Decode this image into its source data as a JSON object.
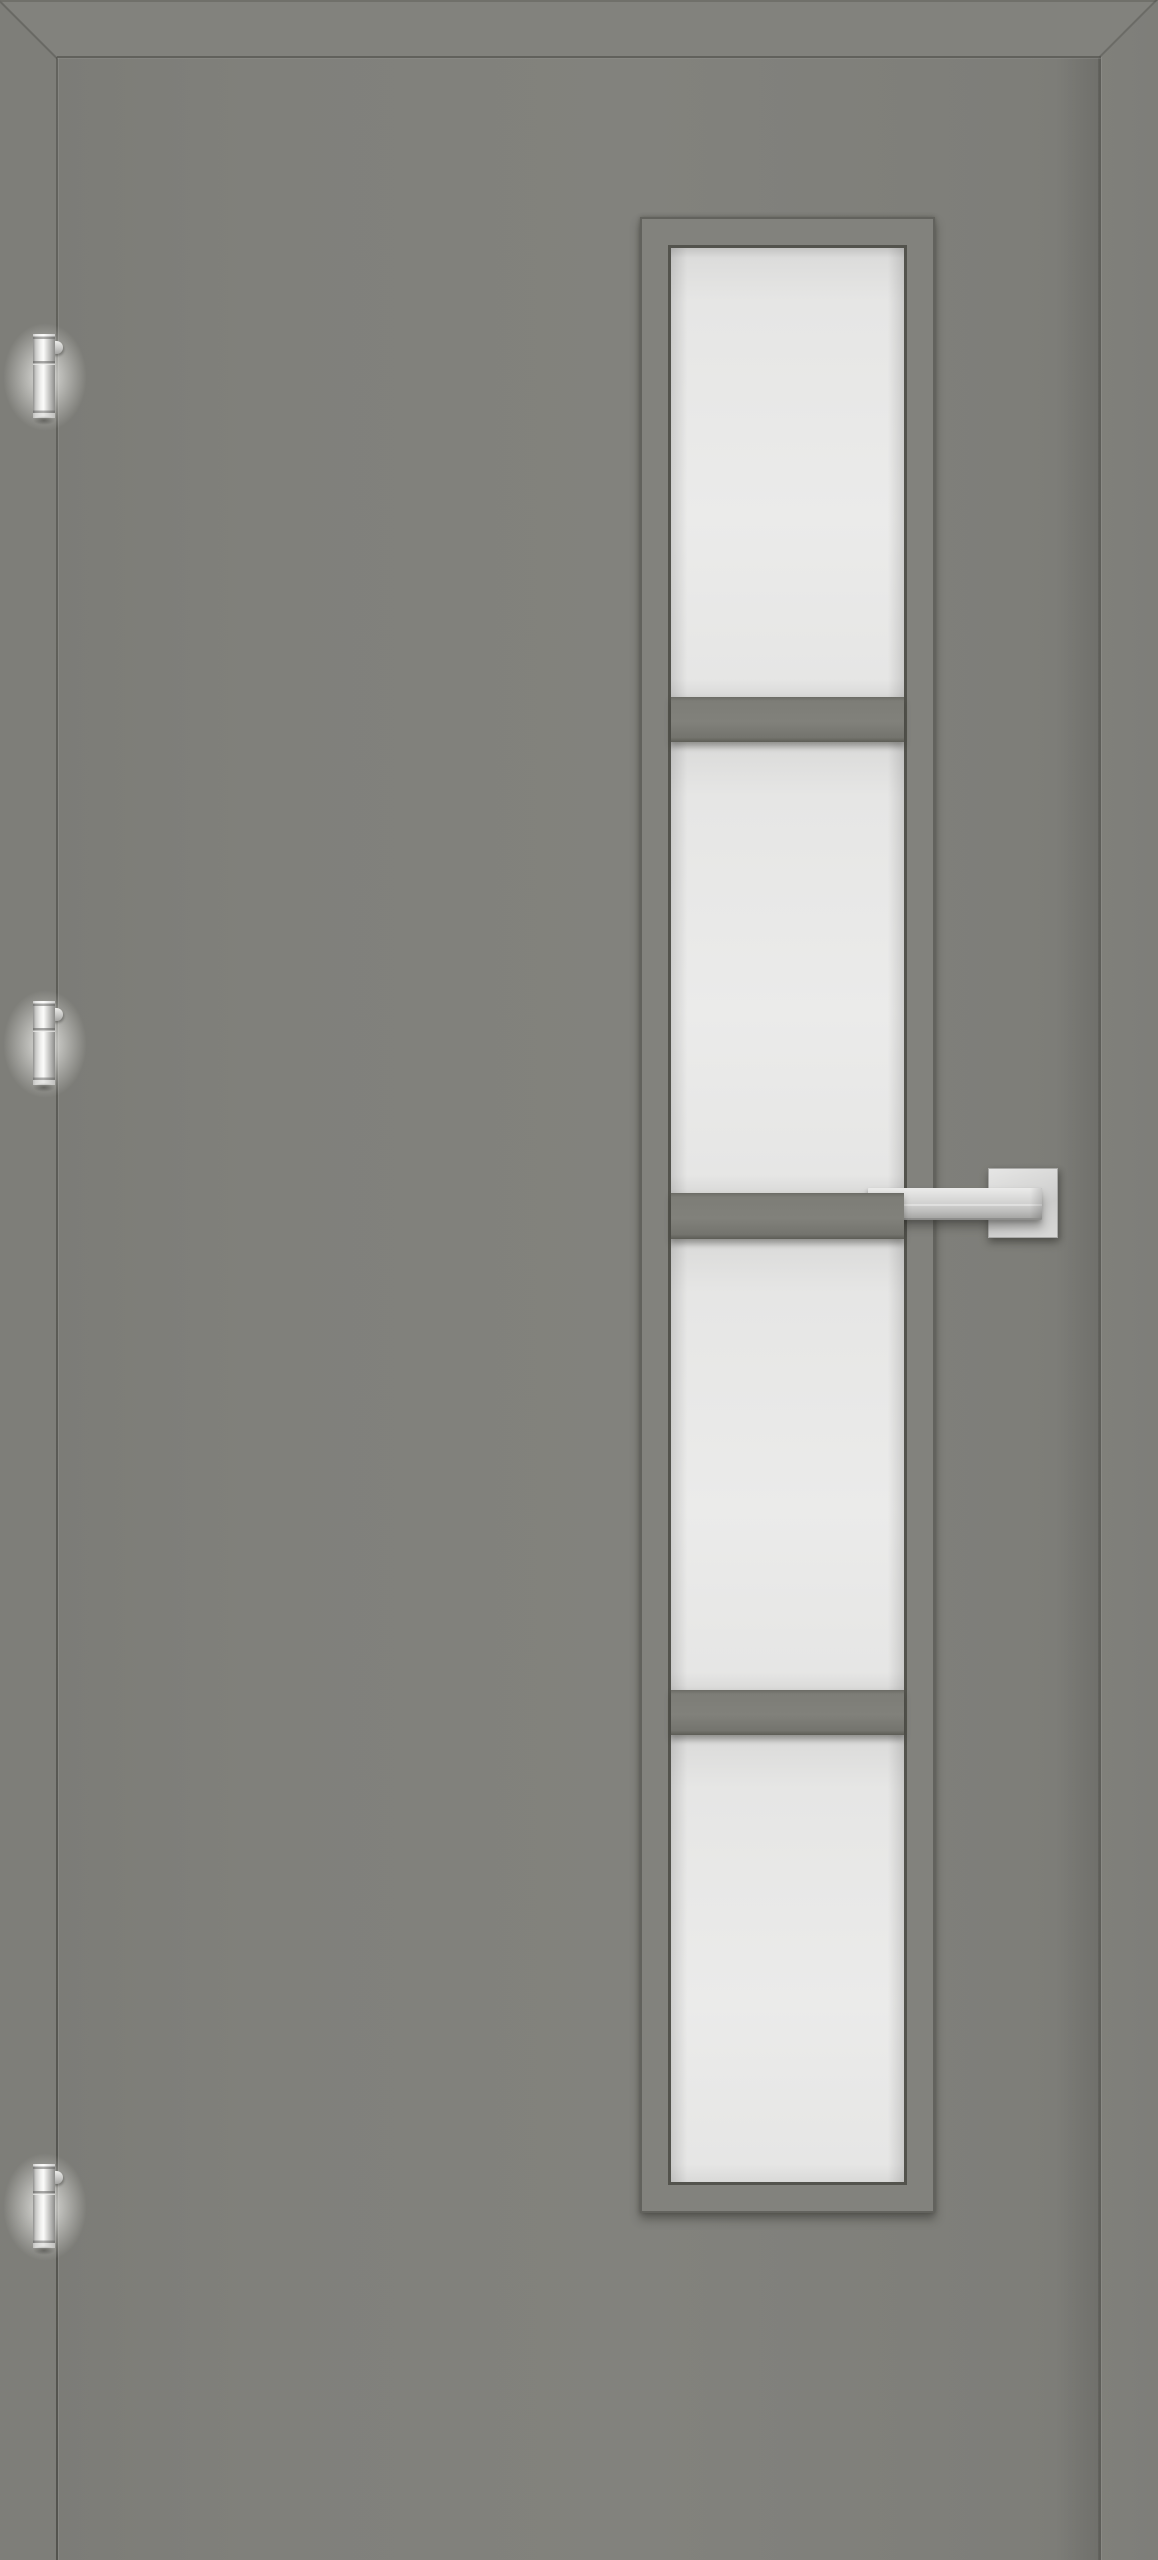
{
  "scene": {
    "type": "product-image",
    "subject": "Grey interior door with vertical 4-pane frosted glazing strip, stainless lever handle, three barrel hinges",
    "door": {
      "edge_width_px": 57,
      "face_color": "#7d7d78",
      "seam_color": "#5a5a55"
    },
    "glazing": {
      "frame": {
        "x": 640,
        "y": 217,
        "width": 295,
        "height": 1996,
        "band_px": 28
      },
      "pane_count": 4,
      "pane_heights_px": [
        450,
        452,
        452,
        448
      ],
      "muntin_height_px": 46,
      "glass_color": "#e8e8e8",
      "frame_color": "#82827d",
      "bead_color": "#53534d"
    },
    "handle": {
      "style": "square-rosette-lever",
      "finish": "brushed-stainless",
      "rosette": {
        "x": 988,
        "y": 1168,
        "size": 70
      },
      "lever": {
        "x": 868,
        "y": 1188,
        "width": 174,
        "height": 30
      }
    },
    "hinges": {
      "count": 3,
      "finish": "silver-barrel",
      "x": 33,
      "width": 22,
      "height": 84,
      "tops_y": [
        334,
        1001,
        2164
      ]
    },
    "colors": {
      "face": "#7d7d78",
      "face_light": "#83837e",
      "band_dark": "#6b6b66",
      "seam": "#5a5a55",
      "frame_outline": "#62625d",
      "bead": "#53534d",
      "glass": "#e8e8e8",
      "glass_edge": "#cfcfce",
      "metal_high": "#fbfbfa",
      "metal_mid": "#d2d2d1",
      "metal_low": "#9a9a98"
    }
  }
}
